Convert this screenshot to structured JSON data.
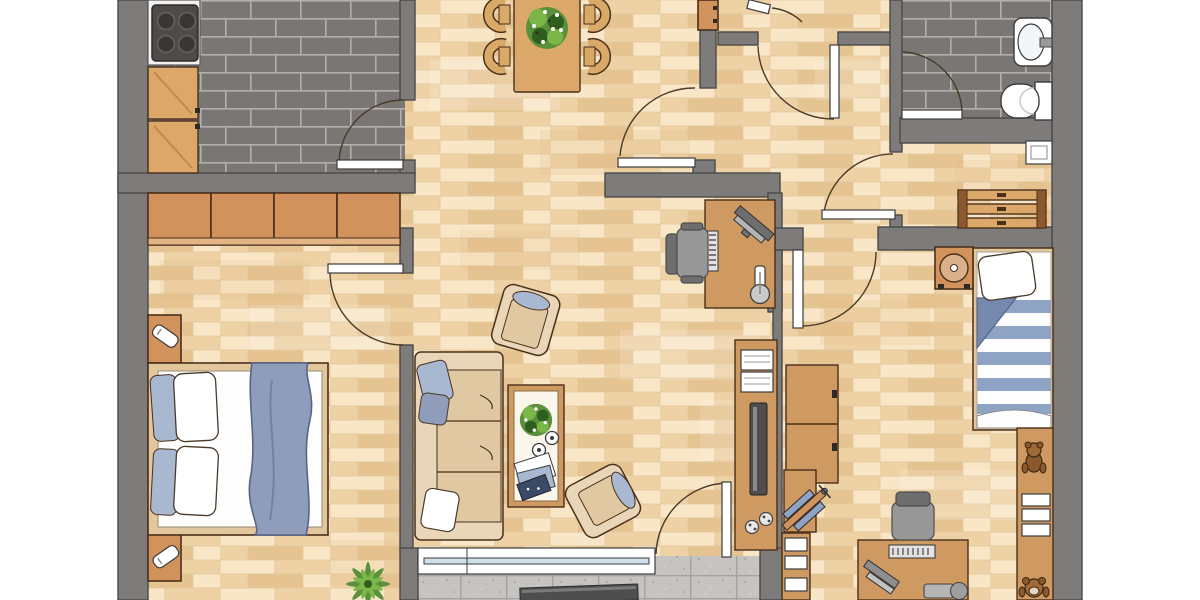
{
  "meta": {
    "title": "Apartment floor plan (top-down architectural rendering)",
    "type": "floor-plan"
  },
  "palette": {
    "wall": "#7e7c7a",
    "wall_outline": "#4c4a48",
    "parquet_base": "#f2d9ae",
    "parquet_light": "#f8e6c6",
    "parquet_mid": "#eed2a6",
    "parquet_dark": "#e6c492",
    "parquet_line": "#e3c89d",
    "tile": "#7a7673",
    "tile_gap": "#b3afac",
    "balcony": "#c6c4c1",
    "balcony_gap": "#a5a3a0",
    "wood": "#dca86a",
    "cabinet": "#d2925c",
    "furniture": "#cf9a62",
    "outline": "#4a2f1b",
    "sofa": "#e9d6b8",
    "sofa_seat": "#dfc8a2",
    "cushion_blue": "#a8b8d0",
    "blanket_blue": "#8f9dbb",
    "blanket_fold": "#6f83a8",
    "stripe_blue": "#8fa3c4",
    "chair_gray": "#979797",
    "chair_gray_dark": "#6e6e6e",
    "tv": "#4e4e4e",
    "appliance": "#4e4a48",
    "plant": "#5a8f3c",
    "plant_light": "#7ab648",
    "plant_dark": "#2f5e1f",
    "glass": "#cfe0e8"
  },
  "rooms": [
    {
      "id": "kitchen",
      "label": "Kitchen",
      "furniture": [
        "stove-top",
        "counter",
        "base-cabinets"
      ]
    },
    {
      "id": "master-bedroom",
      "label": "Master Bedroom",
      "furniture": [
        "wardrobe-row",
        "double-bed",
        "nightstands",
        "bedside-lamps",
        "potted-palm"
      ]
    },
    {
      "id": "dining-area",
      "label": "Dining Area",
      "furniture": [
        "dining-table",
        "four-chairs",
        "table-plant"
      ]
    },
    {
      "id": "living-room",
      "label": "Living Room",
      "furniture": [
        "sofa",
        "coffee-table",
        "two-armchairs",
        "tv-sideboard",
        "game-controllers"
      ]
    },
    {
      "id": "study",
      "label": "Study",
      "furniture": [
        "desk",
        "office-chair",
        "monitor",
        "keyboard",
        "desk-lamp"
      ]
    },
    {
      "id": "hallway",
      "label": "Hallway",
      "furniture": [
        "shoe-cabinet",
        "entrance-door"
      ]
    },
    {
      "id": "bathroom",
      "label": "Bathroom",
      "furniture": [
        "washbasin",
        "toilet"
      ]
    },
    {
      "id": "storage-room",
      "label": "Storage Room",
      "furniture": [
        "slatted-bench",
        "window"
      ]
    },
    {
      "id": "kids-room",
      "label": "Kids Room",
      "furniture": [
        "wardrobe",
        "single-bed",
        "record-player-stand",
        "kids-desk",
        "office-chair",
        "bookshelf",
        "wall-shelf",
        "teddy-bears",
        "toy-biplane"
      ]
    },
    {
      "id": "balcony",
      "label": "Balcony",
      "furniture": [
        "sliding-window",
        "balcony-door"
      ]
    }
  ]
}
